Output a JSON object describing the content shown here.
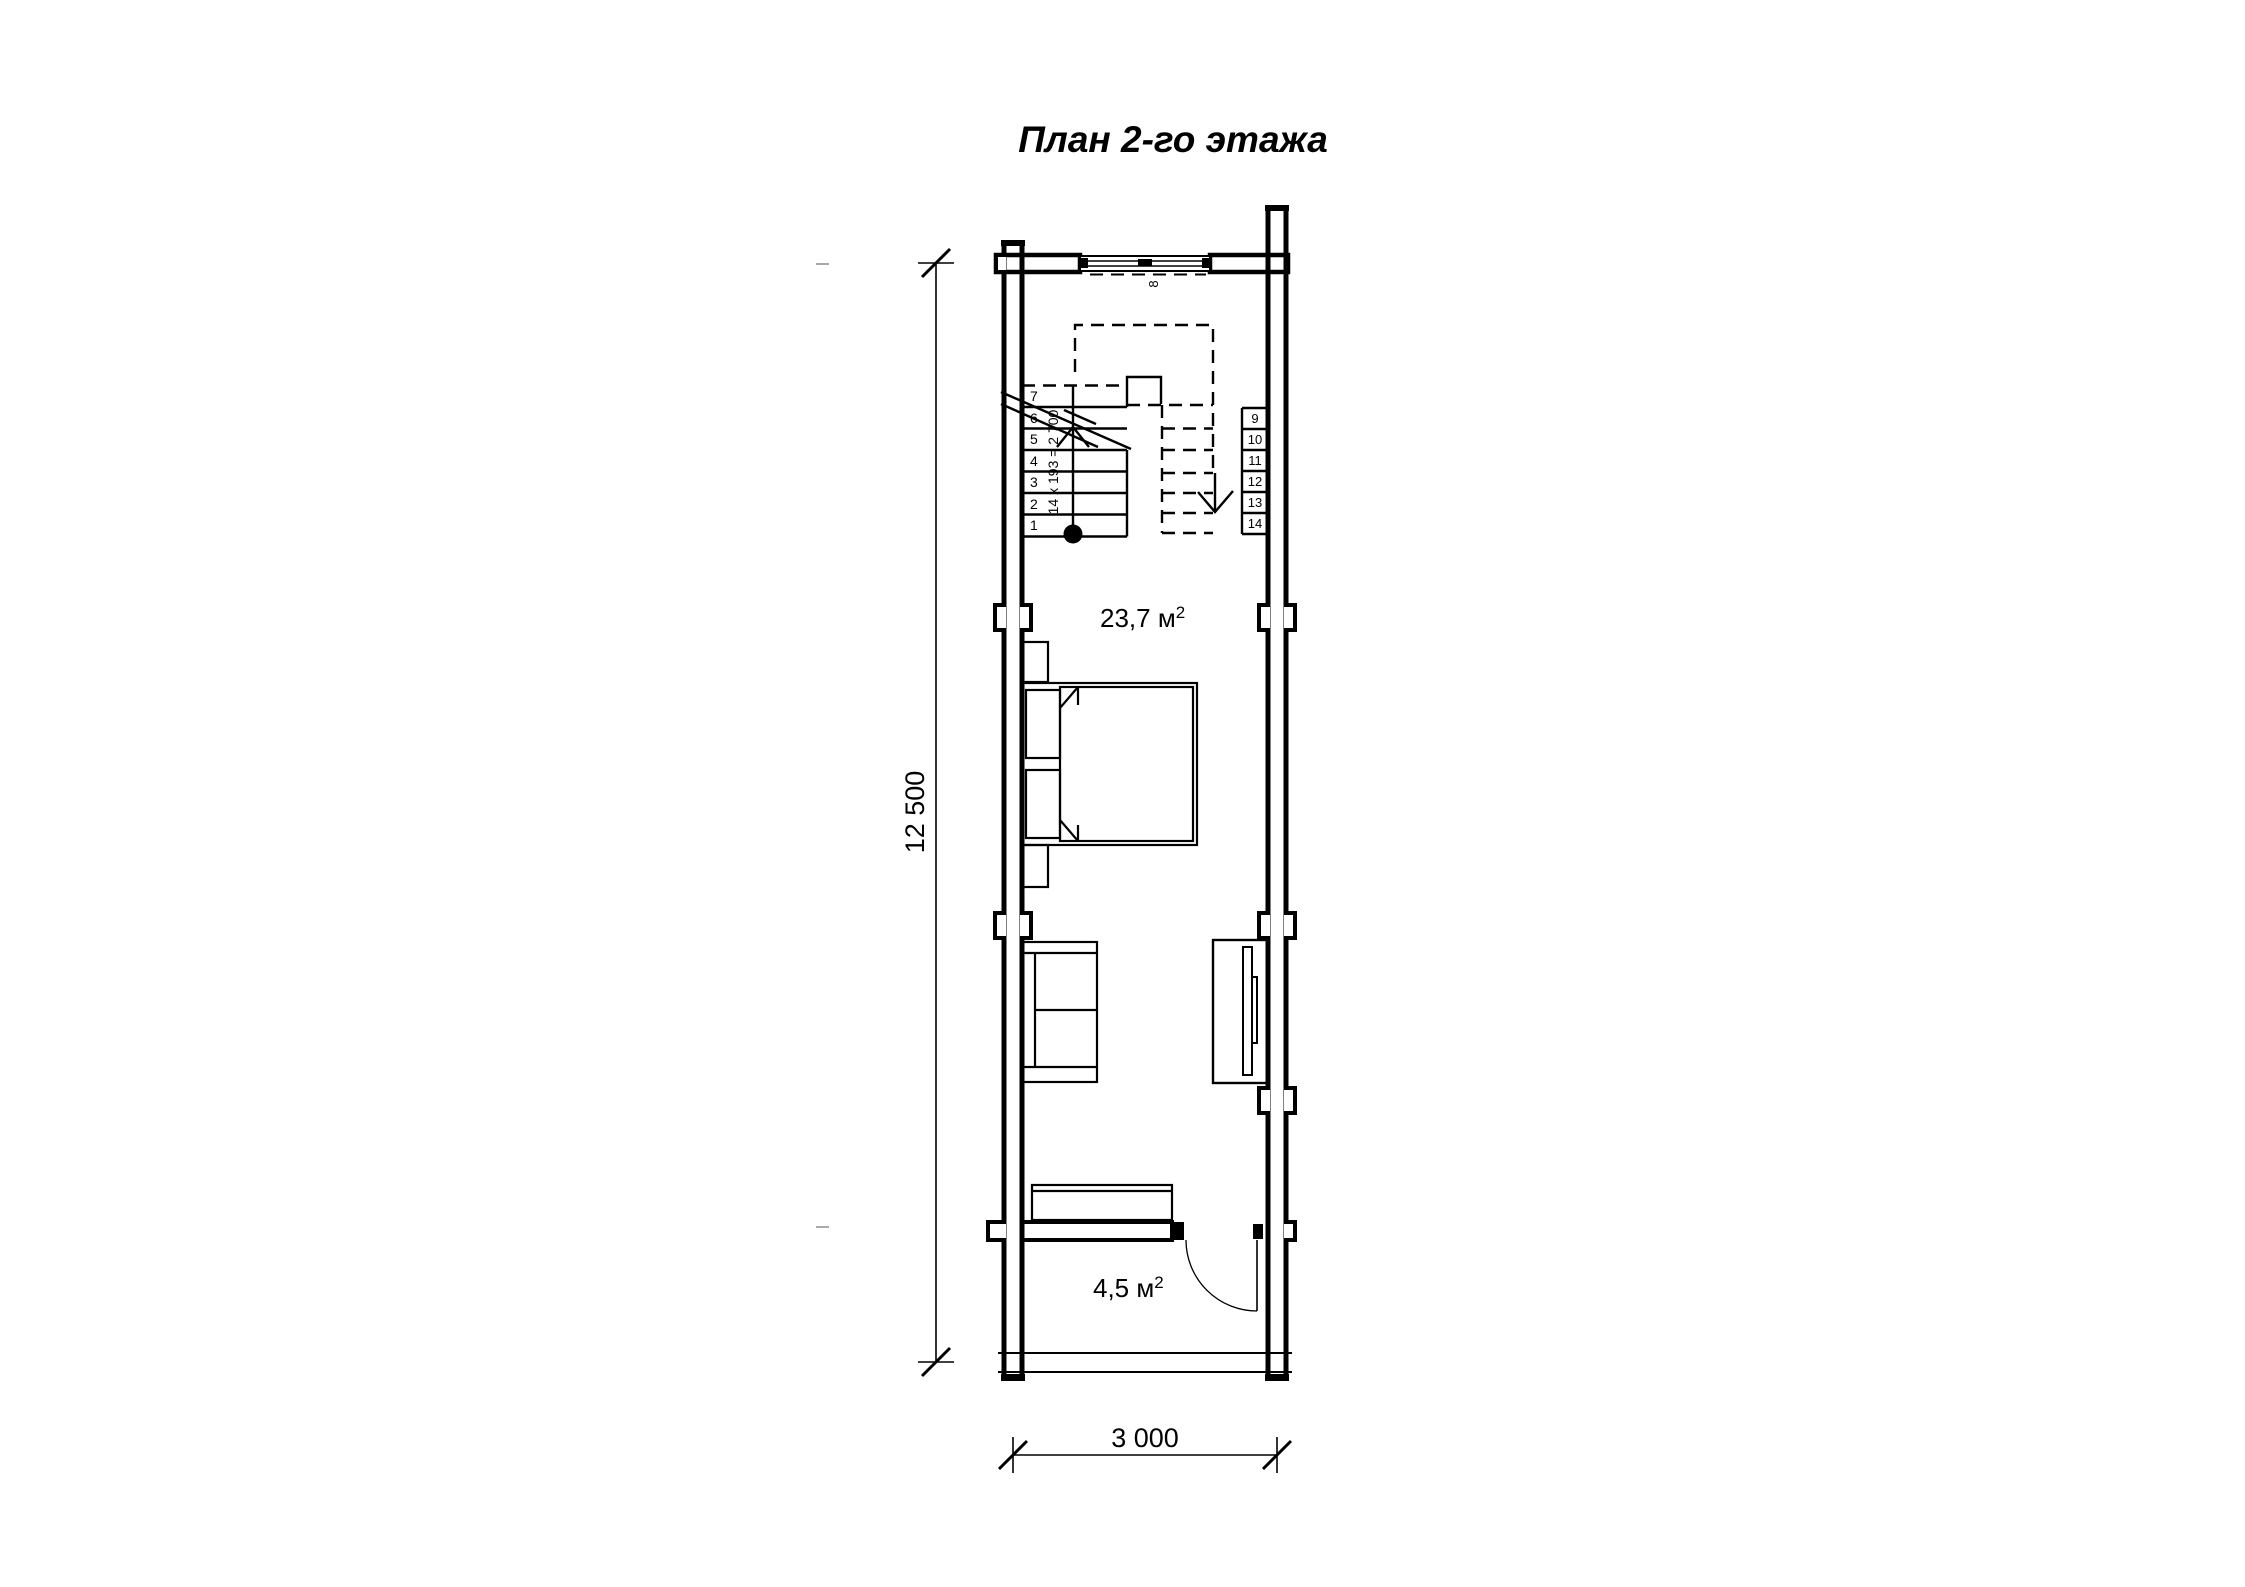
{
  "title": "План 2-го этажа",
  "rooms": {
    "main_area_value": "23,7 м",
    "main_area_sup": "2",
    "small_area_value": "4,5 м",
    "small_area_sup": "2"
  },
  "stairs": {
    "formula": "14 x 193 = 2 700",
    "landing_number": "8",
    "left_steps": [
      "7",
      "6",
      "5",
      "4",
      "3",
      "2",
      "1"
    ],
    "right_steps": [
      "9",
      "10",
      "11",
      "12",
      "13",
      "14"
    ]
  },
  "dimensions": {
    "height_total": "12 500",
    "width_total": "3 000"
  },
  "colors": {
    "ink": "#000000",
    "paper": "#ffffff"
  }
}
